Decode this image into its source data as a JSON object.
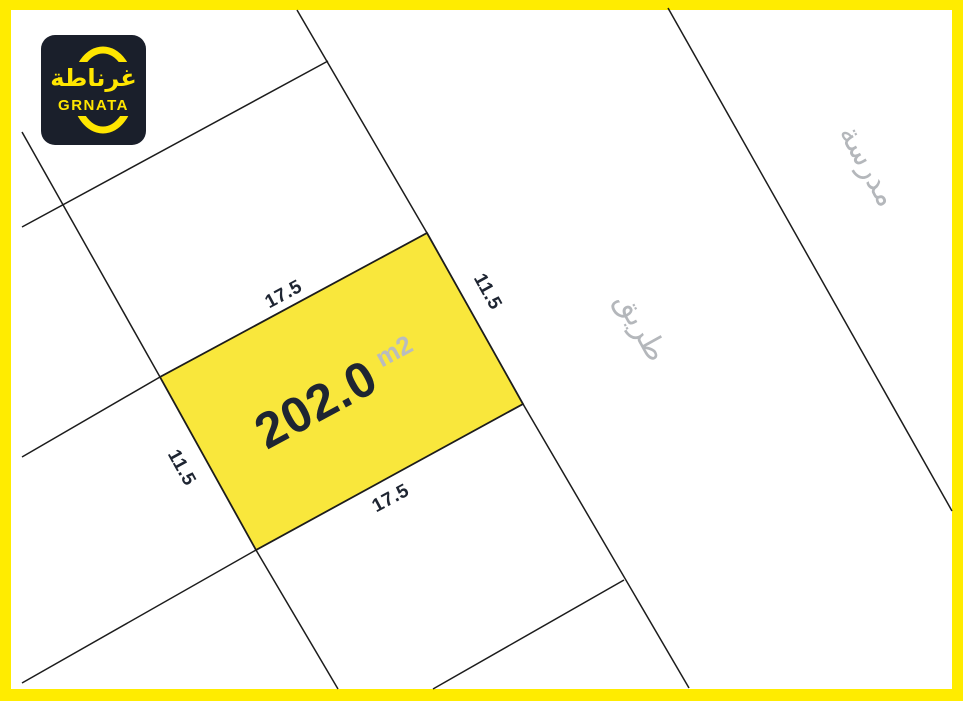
{
  "branding": {
    "logo_arabic": "غرناطة",
    "logo_latin": "GRNATA",
    "logo_background": "#1a1f2b",
    "logo_accent": "#ffe600"
  },
  "frame": {
    "border_color": "#ffec00",
    "paper_color": "#ffffff",
    "boundary_line_color": "#1c1c1c"
  },
  "plot": {
    "area_value": "202.0",
    "area_unit": "m2",
    "fill_color": "#f9e73c",
    "dimensions": {
      "top": "17.5",
      "bottom": "17.5",
      "left": "11.5",
      "right": "11.5"
    }
  },
  "context": {
    "road_label_ar": "طريق",
    "school_label_ar": "مدرسة",
    "label_color": "#b4b7bb"
  }
}
